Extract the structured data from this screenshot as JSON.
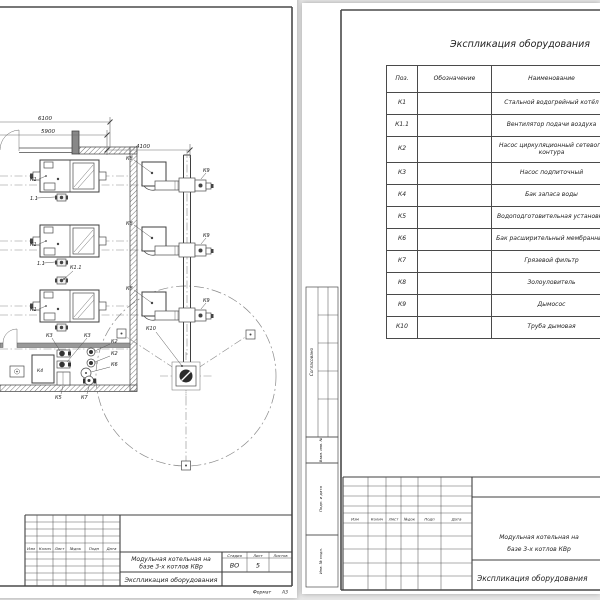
{
  "colors": {
    "background": "#e7e7e7",
    "paper": "#ffffff",
    "line": "#3f3f3f"
  },
  "project": {
    "line1": "Модульная котельная на",
    "line2": "базе 3-х котлов КВр"
  },
  "left_sheet": {
    "dimensions": {
      "total_width": "6100",
      "inner_width": "5900",
      "flue_offset": "4100"
    },
    "labels": {
      "k1": "К1",
      "v1_1": "1.1",
      "k1_1": "К1.1",
      "k2": "К2",
      "k3": "К3",
      "k4": "К4",
      "k5": "К5",
      "k6": "К6",
      "k7": "К7",
      "k8": "К8",
      "k9": "К9",
      "k10": "К10"
    },
    "title_block": {
      "cols": [
        "Изм",
        "Колич",
        "Лист",
        "№док",
        "Подп",
        "Дата"
      ],
      "doc_title": "Экспликация оборудования",
      "stage_label": "Стадия",
      "sheet_label": "Лист",
      "sheets_label": "Листов",
      "stage": "ВО",
      "sheet_num": "5",
      "format_label": "Формат",
      "format_value": "А3"
    }
  },
  "right_sheet": {
    "table_title": "Экспликация оборудования",
    "table": {
      "headers": {
        "pos": "Поз.",
        "designation": "Обозначение",
        "name": "Наименование"
      },
      "rows": [
        {
          "pos": "К1",
          "designation": "",
          "name": "Стальной водогрейный котёл"
        },
        {
          "pos": "К1.1",
          "designation": "",
          "name": "Вентилятор подачи воздуха"
        },
        {
          "pos": "К2",
          "designation": "",
          "name": "Насос циркуляционный сетевого контура"
        },
        {
          "pos": "К3",
          "designation": "",
          "name": "Насос подпиточный"
        },
        {
          "pos": "К4",
          "designation": "",
          "name": "Бак запаса воды"
        },
        {
          "pos": "К5",
          "designation": "",
          "name": "Водоподготовительная установка"
        },
        {
          "pos": "К6",
          "designation": "",
          "name": "Бак расширительный мембранный"
        },
        {
          "pos": "К7",
          "designation": "",
          "name": "Грязевой фильтр"
        },
        {
          "pos": "К8",
          "designation": "",
          "name": "Золоуловитель"
        },
        {
          "pos": "К9",
          "designation": "",
          "name": "Дымосос"
        },
        {
          "pos": "К10",
          "designation": "",
          "name": "Труба дымовая"
        }
      ]
    },
    "side_stamp": {
      "agreed": "Согласовано",
      "vzam": "Взам. инв. №",
      "podp_data": "Подп. и дата",
      "inv": "Инв. № подл."
    },
    "title_block": {
      "cols": [
        "Изм",
        "Колич",
        "Лист",
        "№док",
        "Подп",
        "Дата"
      ],
      "doc_title": "Экспликация оборудования"
    }
  }
}
